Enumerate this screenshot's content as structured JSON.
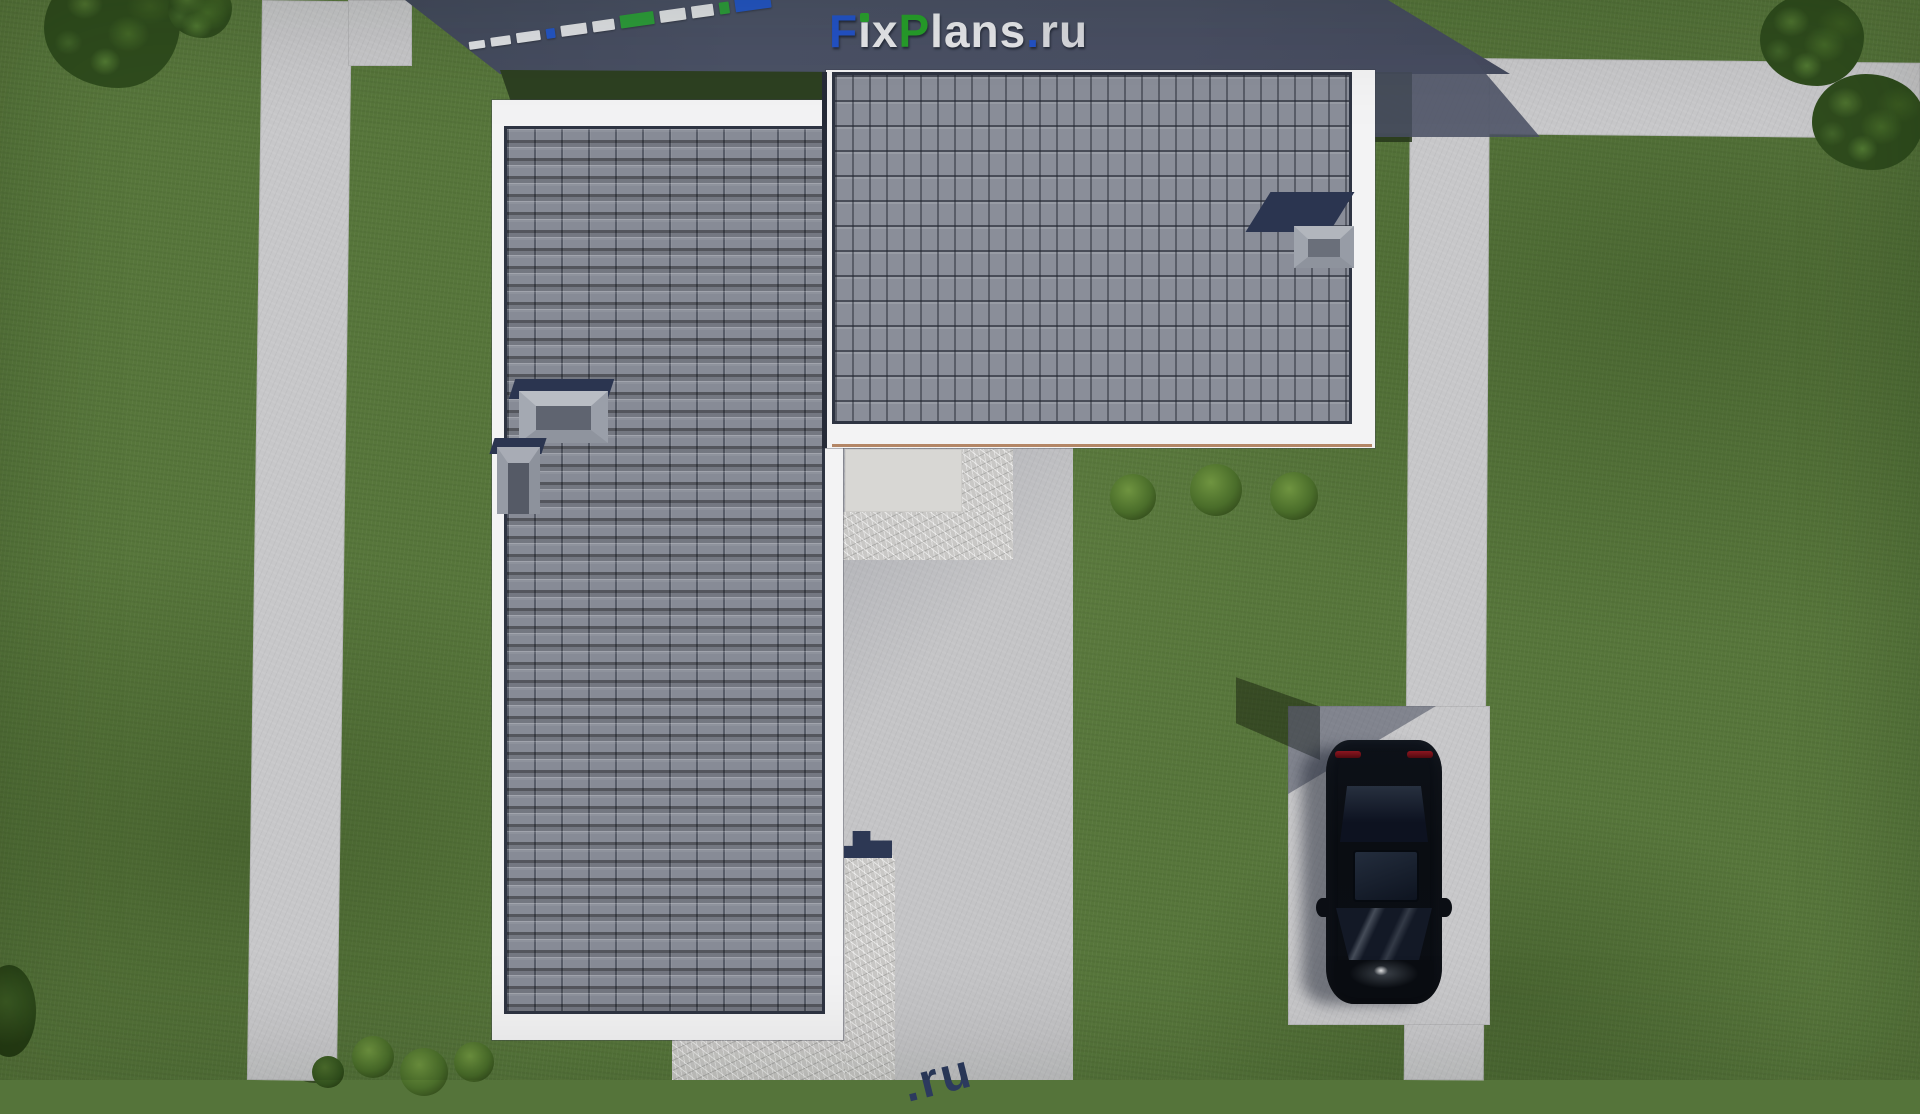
{
  "site": {
    "brand_text": "FixPlans.ru",
    "description_labels": {
      "scene": "aerial-render-of-house-plot",
      "house": "l-shaped-house-dark-tile-roof",
      "vehicle": "black-car-top-view"
    }
  },
  "logo": {
    "letters": [
      {
        "ch": "F",
        "color": "#2353c8"
      },
      {
        "ch": "ı",
        "color": "#e8e9ec",
        "dot": "#2aa12f"
      },
      {
        "ch": "x",
        "color": "#e8e9ec"
      },
      {
        "ch": "P",
        "color": "#27a02b"
      },
      {
        "ch": "l",
        "color": "#e8e9ec"
      },
      {
        "ch": "a",
        "color": "#e8e9ec"
      },
      {
        "ch": "n",
        "color": "#e8e9ec"
      },
      {
        "ch": "s",
        "color": "#e8e9ec"
      },
      {
        "ch": ".",
        "color": "#2353c8"
      },
      {
        "ch": "r",
        "color": "#dadbe0"
      },
      {
        "ch": "u",
        "color": "#dadbe0"
      }
    ]
  },
  "watermark_strip": {
    "blocks": [
      {
        "w": 16,
        "h": 8,
        "c": "#dfe1e4"
      },
      {
        "w": 20,
        "h": 9,
        "c": "#dfe1e4"
      },
      {
        "w": 24,
        "h": 10,
        "c": "#dfe1e4"
      },
      {
        "w": 9,
        "h": 10,
        "c": "#2456c4"
      },
      {
        "w": 26,
        "h": 11,
        "c": "#dfe1e4"
      },
      {
        "w": 22,
        "h": 11,
        "c": "#dfe1e4"
      },
      {
        "w": 34,
        "h": 13,
        "c": "#2d9c3a"
      },
      {
        "w": 26,
        "h": 12,
        "c": "#dfe1e4"
      },
      {
        "w": 22,
        "h": 12,
        "c": "#dfe1e4"
      },
      {
        "w": 10,
        "h": 12,
        "c": "#2d9c3a"
      },
      {
        "w": 36,
        "h": 24,
        "c": "#2456c4"
      }
    ]
  },
  "bottom_watermark": {
    "text": ".ru",
    "color": "#2c3a5e"
  },
  "palette": {
    "grass": "#57763b",
    "grass_shadow": "#2d4021",
    "concrete": "#c7c7c9",
    "courtyard": "#c4c4c6",
    "slate_shadow": "#4a5064",
    "roof_tile": "#878b96",
    "roof_gap": "#2e3442",
    "fascia_white": "#f3f3f4",
    "gutter_brown": "#a26a42",
    "navy_shadow": "#2b3550",
    "car_black": "#0b0e14",
    "car_taillight_red": "#8c1620",
    "logo_blue": "#2353c8",
    "logo_green": "#27a02b",
    "logo_white": "#e8e9ec"
  }
}
